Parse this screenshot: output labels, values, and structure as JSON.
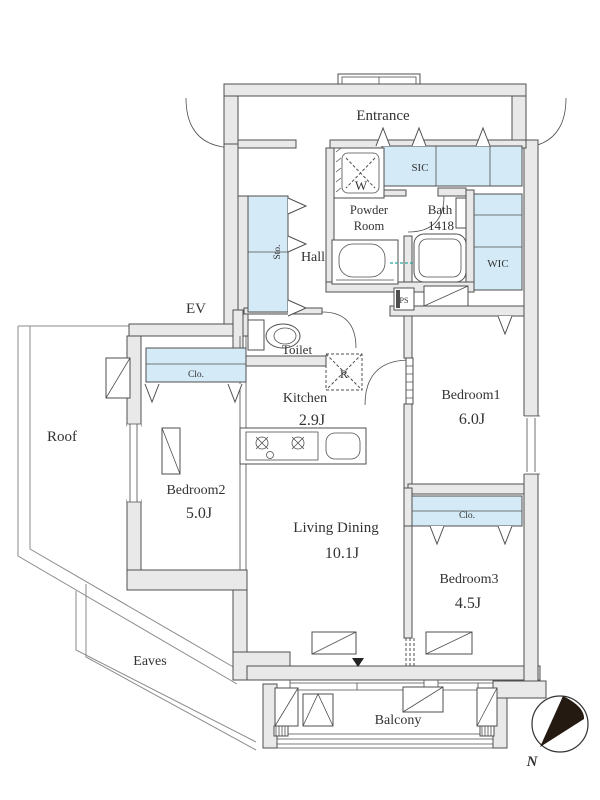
{
  "plan": {
    "rooms": {
      "entrance": {
        "label": "Entrance"
      },
      "ev": {
        "label": "EV"
      },
      "hall": {
        "label": "Hall"
      },
      "powder_room": {
        "label_line1": "Powder",
        "label_line2": "Room"
      },
      "bath": {
        "label": "Bath",
        "size": "1418"
      },
      "toilet": {
        "label": "Toilet"
      },
      "kitchen": {
        "label": "Kitchen",
        "area": "2.9J"
      },
      "living_dining": {
        "label": "Living Dining",
        "area": "10.1J"
      },
      "bedroom1": {
        "label": "Bedroom1",
        "area": "6.0J"
      },
      "bedroom2": {
        "label": "Bedroom2",
        "area": "5.0J"
      },
      "bedroom3": {
        "label": "Bedroom3",
        "area": "4.5J"
      },
      "balcony": {
        "label": "Balcony"
      },
      "roof": {
        "label": "Roof"
      },
      "eaves": {
        "label": "Eaves"
      }
    },
    "storage": {
      "sic": {
        "label": "SIC"
      },
      "wic": {
        "label": "WIC"
      },
      "sto": {
        "label": "Sto."
      },
      "closet_bedroom2": {
        "label": "Clo."
      },
      "closet_bedroom3": {
        "label": "Clo."
      },
      "ps": {
        "label": "PS"
      },
      "washer": {
        "label": "W"
      },
      "refrigerator": {
        "label": "R"
      }
    },
    "compass": {
      "north_label": "N"
    },
    "colors": {
      "wall_fill": "#e9e9e9",
      "closet_fill": "#d4eaf7",
      "line": "#4f4f4f",
      "text": "#333333",
      "plumbing_dash": "#2aa7a0"
    }
  }
}
